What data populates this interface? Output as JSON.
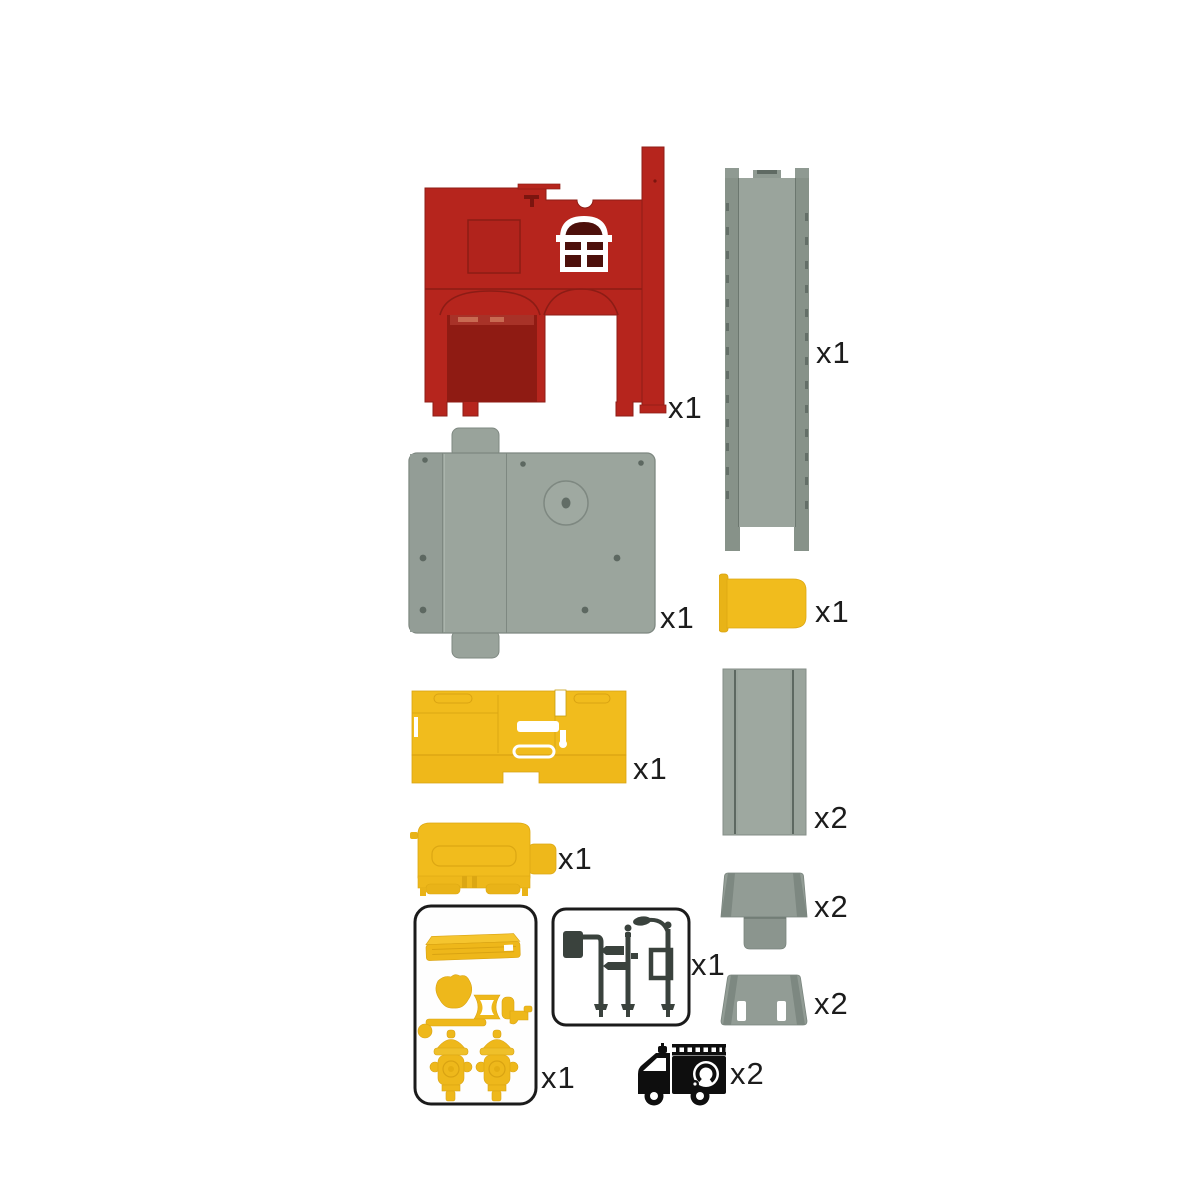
{
  "document": {
    "kind": "toy playset parts list",
    "background": "#ffffff"
  },
  "colors": {
    "red": "#b6251d",
    "red_door": "#8f1b13",
    "red_shadow": "#8c1c15",
    "window_pane": "#4d100b",
    "yellow": "#f1bc1d",
    "yellow_dark": "#d9a312",
    "gray": "#949e97",
    "gray_dark": "#7d8881",
    "gray_line": "#5d6861",
    "sign_dark": "#3a423d",
    "icon_black": "#0e0e0e",
    "ink": "#1c1c1c",
    "white": "#ffffff"
  },
  "parts": [
    {
      "name": "fire-station-front-wall",
      "qty": "x1"
    },
    {
      "name": "elevated-track-column",
      "qty": "x1"
    },
    {
      "name": "base-plate",
      "qty": "x1"
    },
    {
      "name": "small-door-panel",
      "qty": "x1"
    },
    {
      "name": "garage-wall-panel",
      "qty": "x1"
    },
    {
      "name": "straight-road-section",
      "qty": "x2"
    },
    {
      "name": "vehicle-body-block",
      "qty": "x1"
    },
    {
      "name": "ramp-end-with-tab",
      "qty": "x2"
    },
    {
      "name": "ramp-end-with-slots",
      "qty": "x2"
    },
    {
      "name": "accessory-sprue-set",
      "qty": "x1"
    },
    {
      "name": "street-lamp-and-sign-set",
      "qty": "x1"
    },
    {
      "name": "fire-truck",
      "qty": "x2"
    }
  ]
}
